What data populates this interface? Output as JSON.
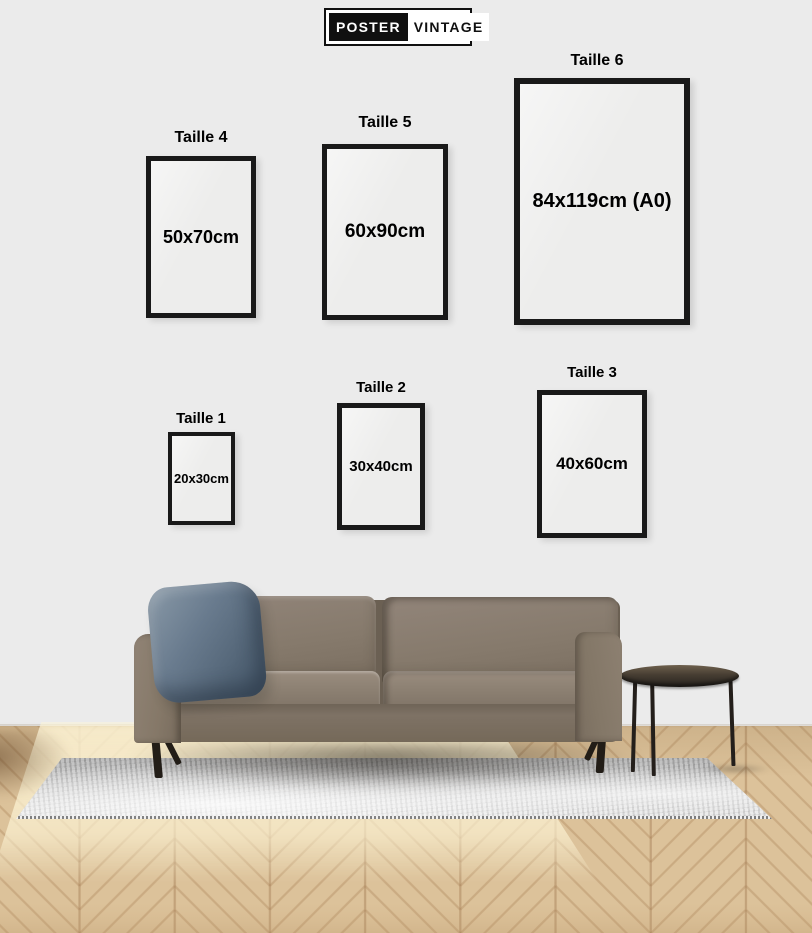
{
  "logo": {
    "left": "POSTER",
    "right": "VINTAGE"
  },
  "sizes": [
    {
      "id": "taille-4",
      "label": "Taille 4",
      "dimensions": "50x70cm"
    },
    {
      "id": "taille-5",
      "label": "Taille 5",
      "dimensions": "60x90cm"
    },
    {
      "id": "taille-6",
      "label": "Taille 6",
      "dimensions": "84x119cm (A0)"
    },
    {
      "id": "taille-1",
      "label": "Taille 1",
      "dimensions": "20x30cm"
    },
    {
      "id": "taille-2",
      "label": "Taille 2",
      "dimensions": "30x40cm"
    },
    {
      "id": "taille-3",
      "label": "Taille 3",
      "dimensions": "40x60cm"
    }
  ],
  "colors": {
    "wall": "#ebebeb",
    "frame_border": "#191919",
    "text": "#000000",
    "logo_block": "#101010",
    "sofa": "#857868",
    "pillow": "#5f7183",
    "rug": "#cfcfcf",
    "floor_wood": "#d8bd93",
    "table": "#2a2521"
  }
}
